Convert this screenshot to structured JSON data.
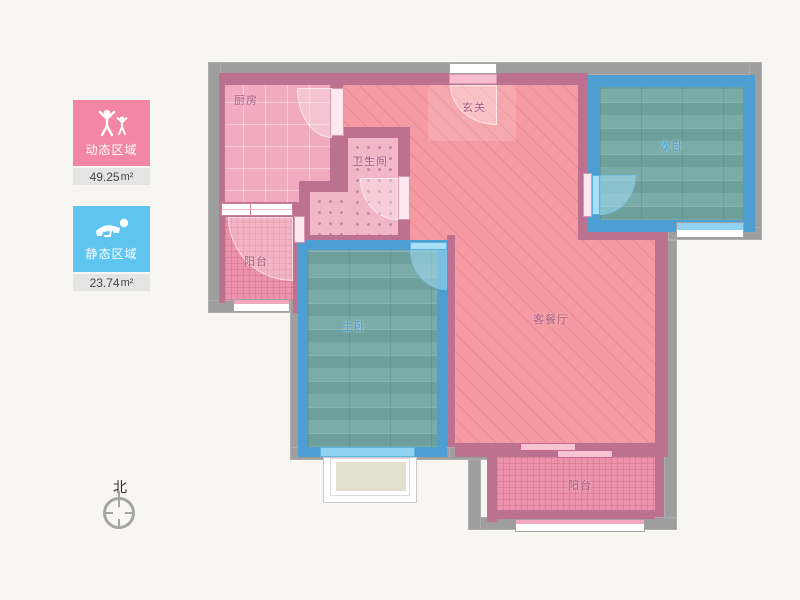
{
  "legend": {
    "dynamic": {
      "label": "动态区域",
      "area": "49.25",
      "unit": "m²",
      "color": "#f286a3"
    },
    "static": {
      "label": "静态区域",
      "area": "23.74",
      "unit": "m²",
      "color": "#5ec5f0"
    }
  },
  "compass": {
    "north_label": "北"
  },
  "rooms": {
    "kitchen": "厨房",
    "entrance": "玄关",
    "bathroom": "卫生间",
    "second_bedroom": "次卧",
    "master_bedroom": "主卧",
    "living_dining": "客餐厅",
    "balcony_left": "阳台",
    "balcony_bottom": "阳台"
  },
  "colors": {
    "wall_exterior_gray": "#9e9e9e",
    "wall_interior_pink": "#bc7190",
    "wall_bedroom_blue": "#4d9ed3",
    "floor_living_pink": "#f59aa2",
    "floor_wood_teal": "#73a7a4",
    "legend_dynamic_pink": "#f286a3",
    "legend_static_blue": "#5ec5f0"
  }
}
